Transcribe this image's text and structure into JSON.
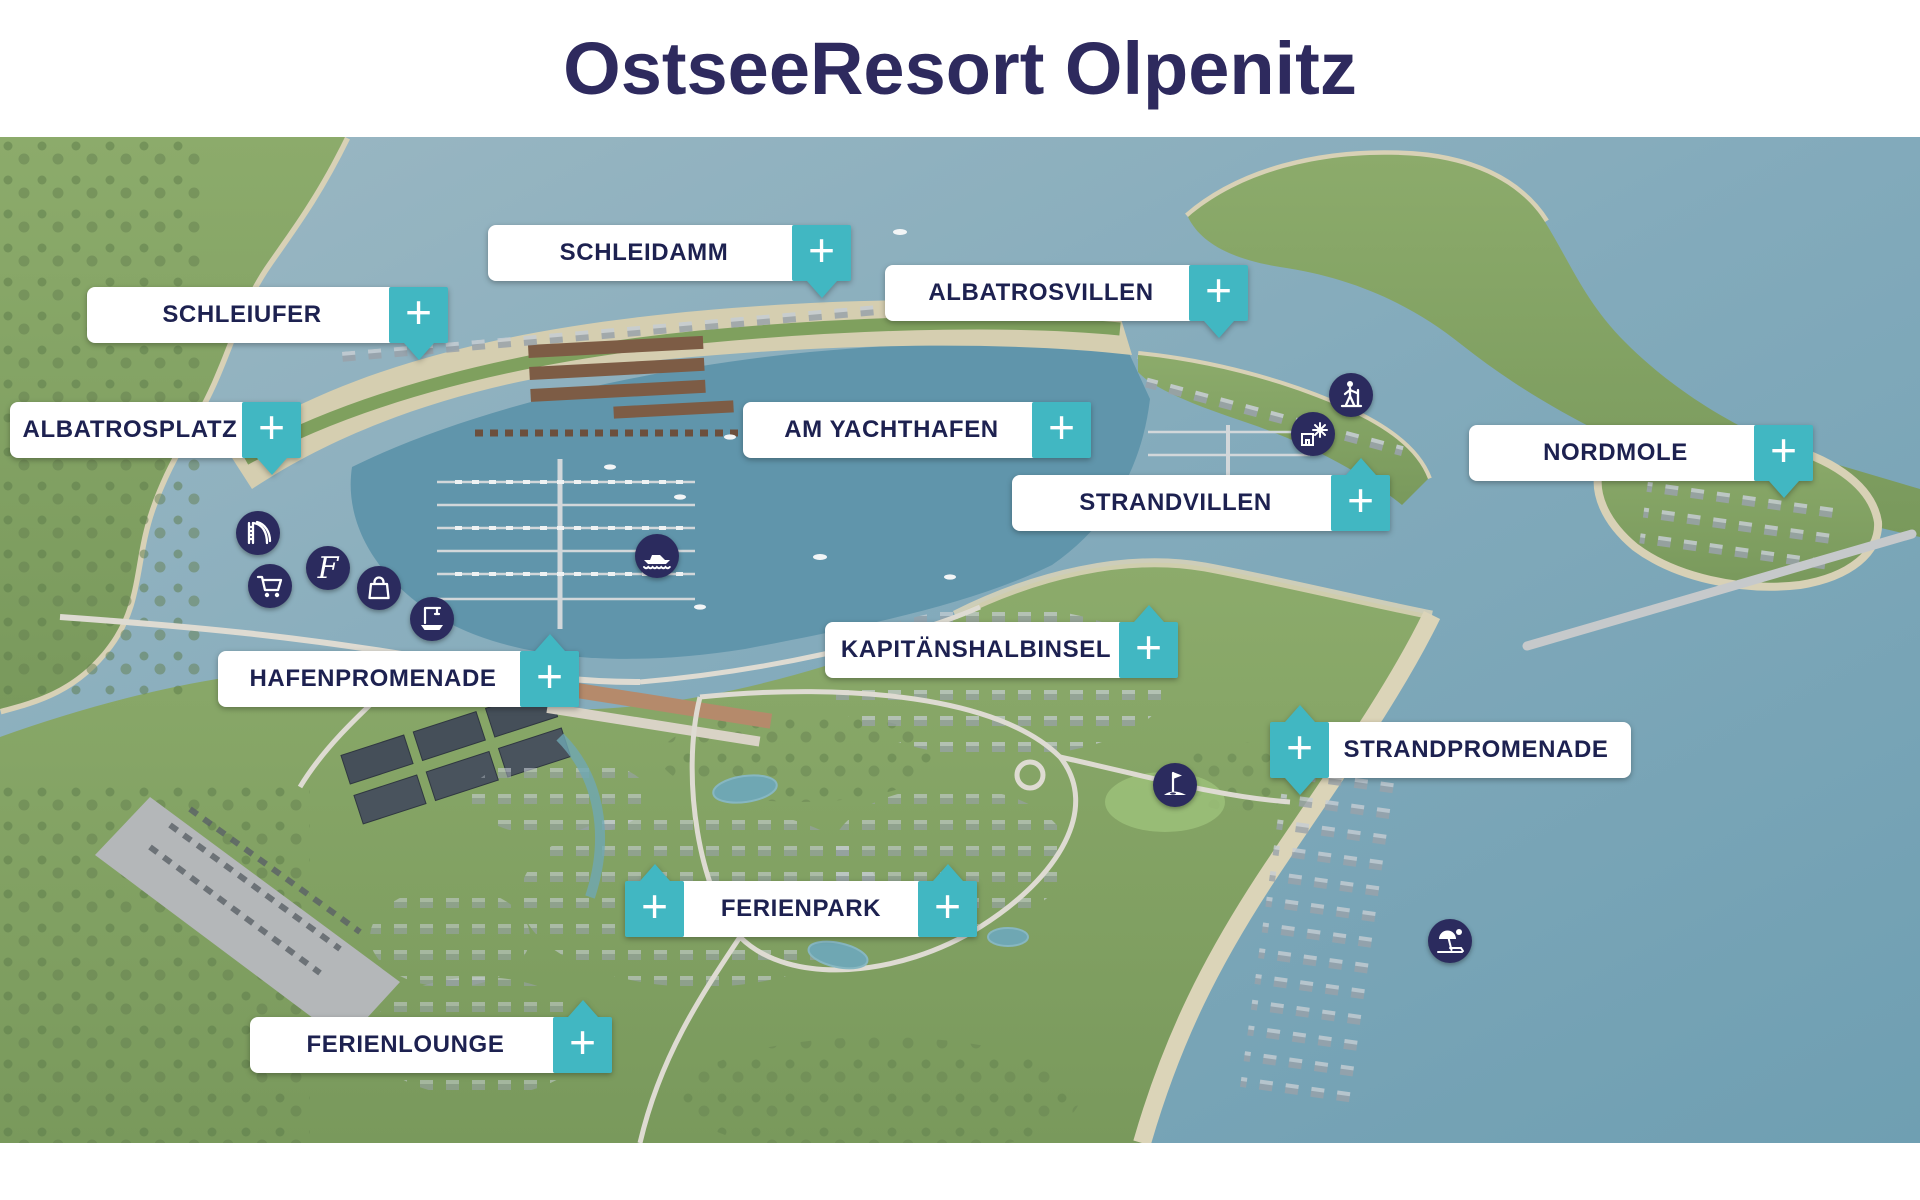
{
  "title": "OstseeResort Olpenitz",
  "plus_symbol": "+",
  "colors": {
    "accent_teal": "#41b7c2",
    "title_navy": "#2e2a5e",
    "label_text_navy": "#1d2150",
    "marker_circle_navy": "#2b2b5e"
  },
  "labels": [
    {
      "id": "schleidamm",
      "text": "SCHLEIDAMM"
    },
    {
      "id": "schleiufer",
      "text": "SCHLEIUFER"
    },
    {
      "id": "albatrosplatz",
      "text": "ALBATROSPLATZ"
    },
    {
      "id": "albatrosvillen",
      "text": "ALBATROSVILLEN"
    },
    {
      "id": "am-yachthafen",
      "text": "AM YACHTHAFEN"
    },
    {
      "id": "nordmole",
      "text": "NORDMOLE"
    },
    {
      "id": "strandvillen",
      "text": "STRANDVILLEN"
    },
    {
      "id": "kapitaenshalbinsel",
      "text": "KAPITÄNSHALBINSEL"
    },
    {
      "id": "hafenpromenade",
      "text": "HAFENPROMENADE"
    },
    {
      "id": "strandpromenade",
      "text": "STRANDPROMENADE"
    },
    {
      "id": "ferienpark",
      "text": "FERIENPARK"
    },
    {
      "id": "ferienlounge",
      "text": "FERIENLOUNGE"
    }
  ],
  "markers": [
    {
      "id": "water-slide",
      "label": "water slide"
    },
    {
      "id": "letter-f",
      "label": "script letter F",
      "glyph": "F"
    },
    {
      "id": "shopping-cart",
      "label": "shopping cart"
    },
    {
      "id": "shopping-bag",
      "label": "shopping bag"
    },
    {
      "id": "boat-crane",
      "label": "boat crane"
    },
    {
      "id": "motorboat",
      "label": "motorboat"
    },
    {
      "id": "hiker",
      "label": "hiker"
    },
    {
      "id": "windmill",
      "label": "windmill house"
    },
    {
      "id": "golf-flag",
      "label": "golf flag"
    },
    {
      "id": "beach-umbrella",
      "label": "beach umbrella"
    }
  ]
}
